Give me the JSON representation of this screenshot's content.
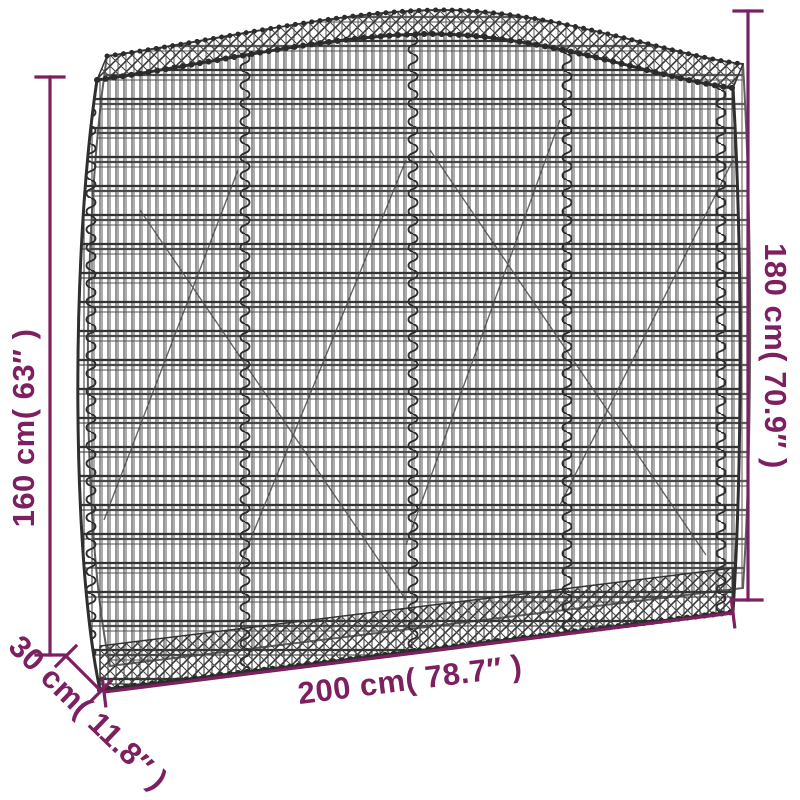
{
  "figure": {
    "subject": "arched gabion wire mesh basket dimension diagram",
    "background_color": "#ffffff",
    "wire_color": "#3a3a3a",
    "accent_color": "#7d2060"
  },
  "labels": {
    "height_left": "160 cm( 63″ )",
    "height_right": "180 cm( 70.9″ )",
    "width_bottom": "200 cm( 78.7″ )",
    "depth": "30 cm( 11.8″ )"
  }
}
